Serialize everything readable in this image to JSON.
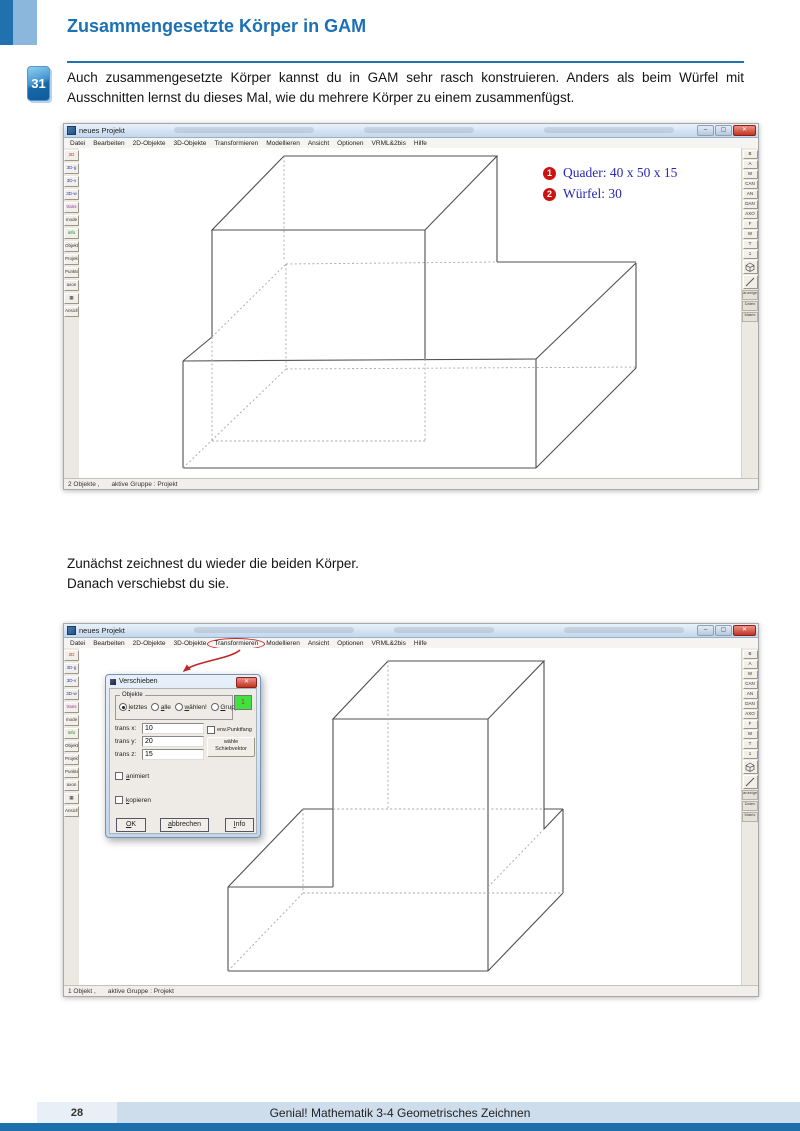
{
  "page": {
    "header": {
      "badge": "31",
      "title": "Zusammengesetzte Körper in GAM",
      "intro": "Auch zusammengesetzte Körper kannst du in GAM sehr rasch konstruieren. Anders als beim Würfel mit Ausschnitten lernst du dieses Mal, wie du mehrere Körper zu einem zusammenfügst."
    },
    "between": {
      "line1": "Zunächst zeichnest du wieder die beiden Körper.",
      "line2": "Danach verschiebst du sie."
    },
    "footer": {
      "page_number": "28",
      "book_title": "Genial! Mathematik 3-4 Geometrisches Zeichnen"
    },
    "colors": {
      "accent_blue": "#1c71b4",
      "annotation_blue": "#2a2aad",
      "badge_red": "#cc1111",
      "footer_bar": "#cdddec",
      "footer_dark": "#1c6fad"
    }
  },
  "gam": {
    "window_title": "neues Projekt",
    "window_controls": {
      "minimize": "–",
      "maximize": "▢",
      "close": "✕"
    },
    "menu": [
      "Datei",
      "Bearbeiten",
      "2D-Objekte",
      "3D-Objekte",
      "Transformieren",
      "Modellieren",
      "Ansicht",
      "Optionen",
      "VRML&2bis",
      "Hilfe"
    ],
    "left_toolbar": [
      {
        "t": "2D",
        "c": "#c03030"
      },
      {
        "t": "3D-g",
        "c": "#2040c0"
      },
      {
        "t": "3D-v",
        "c": "#2040c0"
      },
      {
        "t": "3D-w",
        "c": "#2040c0"
      },
      {
        "t": "trans",
        "c": "#9030a0"
      },
      {
        "t": "mode",
        "c": "#333333"
      },
      {
        "t": "info",
        "c": "#208020"
      },
      {
        "t": "Objekt",
        "c": "#333333"
      },
      {
        "t": "Projekt",
        "c": "#333333"
      },
      {
        "t": "Punkte",
        "c": "#333333"
      },
      {
        "t": "axon",
        "c": "#333333"
      },
      {
        "t": "▦",
        "c": "#333333"
      },
      {
        "t": "Ansicht",
        "c": "#333333"
      }
    ],
    "right_toolbar": {
      "buttons": [
        "B",
        "A",
        "W",
        "CAN",
        "AN",
        "DAN",
        "AXO",
        "F",
        "W",
        "T",
        "1"
      ],
      "chips": [
        "anzeigen",
        "Daten",
        "Matrix"
      ]
    },
    "shot1": {
      "status_objects": "2 Objekte ,",
      "status_group": "aktive Gruppe : Projekt",
      "annotations": [
        {
          "num": "1",
          "text": "Quader: 40 x 50 x 15"
        },
        {
          "num": "2",
          "text": "Würfel: 30"
        }
      ]
    },
    "shot2": {
      "status_objects": "1 Objekt ,",
      "status_group": "aktive Gruppe : Projekt"
    },
    "dialog": {
      "title": "Verschieben",
      "group_label": "Objekte",
      "radios": [
        "letztes",
        "alle",
        "wählen!",
        "Gruppe"
      ],
      "group_value": "1",
      "fields": [
        {
          "label": "trans x:",
          "value": "10"
        },
        {
          "label": "trans y:",
          "value": "20"
        },
        {
          "label": "trans z:",
          "value": "15"
        }
      ],
      "punktfang": "erw.Punktfang",
      "vector_line1": "wähle",
      "vector_line2": "Schiebvektor",
      "animiert": "animiert",
      "kopieren": "kopieren",
      "ok": "OK",
      "cancel": "abbrechen",
      "info": "Info"
    }
  }
}
